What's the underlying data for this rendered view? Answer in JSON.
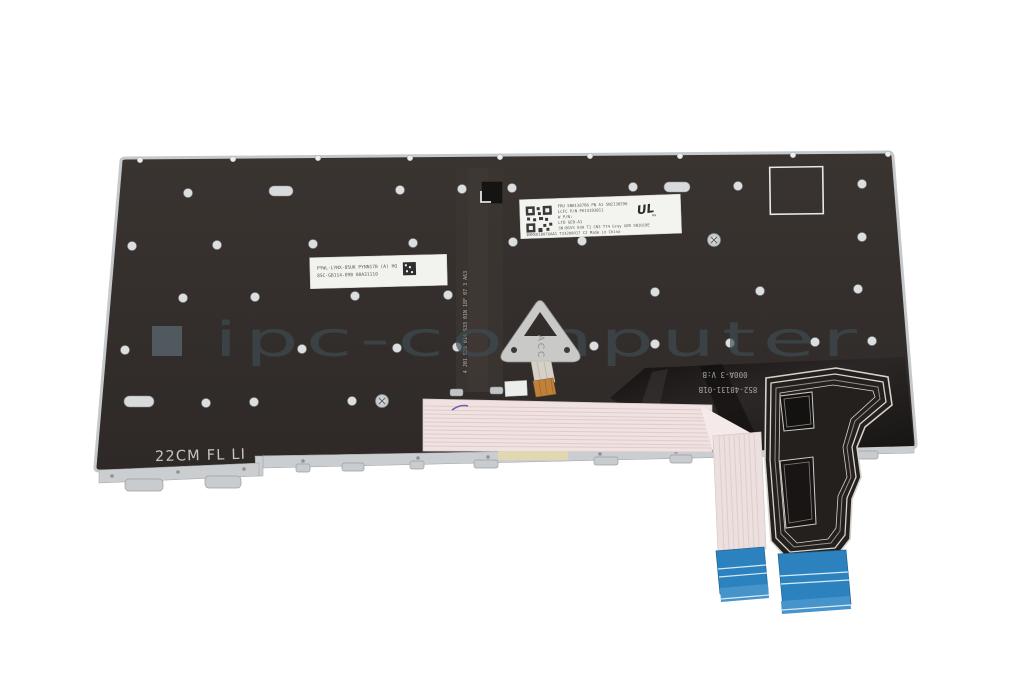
{
  "photo": {
    "subject": "Rear side of a laptop keyboard backplate with backlight foil and ribbon cables",
    "watermark": {
      "text": "ipc-computer"
    },
    "plate": {
      "size_marking": "22CM FL LI",
      "bracket_stamp": "ACC",
      "vertical_print": "4 J01 S29 014 S33 01N 18F 07  3 A63",
      "top_label": {
        "lines": [
          "FRU 5N0138766 PN A1 5N2138296",
          "LCFC P/N PK131D3B11",
          "W P/N:",
          "LTD GER-A1",
          "SN:B1VS 03A T1 CN3 T74 Gray GER 5N1019E",
          "B9KKU1D076AA1 T23200017 C2 Made in China"
        ],
        "ul_mark": "UL",
        "ul_mark_suffix": "us"
      },
      "side_label": {
        "lines": [
          "PYWL-LYNX-85UK PYNN17B (A) HQ",
          "8SC-GB114-09B 00A31110"
        ]
      }
    },
    "backlight_flex": {
      "print_line1": "000A-3 V:B",
      "print_line2": "852-48131-01B"
    },
    "colors": {
      "background": "#ffffff",
      "plate": "#332e2b",
      "rim_silver": "#cbced0",
      "label_white": "#f3f3ef",
      "watermark_gray": "#5b6a72",
      "ribbon_pink": "#efe2e1",
      "connector_blue": "#2d83c0",
      "backlight_flex_black": "#1f1c1b",
      "trace_silver": "#d8d3cb",
      "bracket_silver": "#c9c9c7",
      "orange_connector": "#c2813a"
    }
  }
}
